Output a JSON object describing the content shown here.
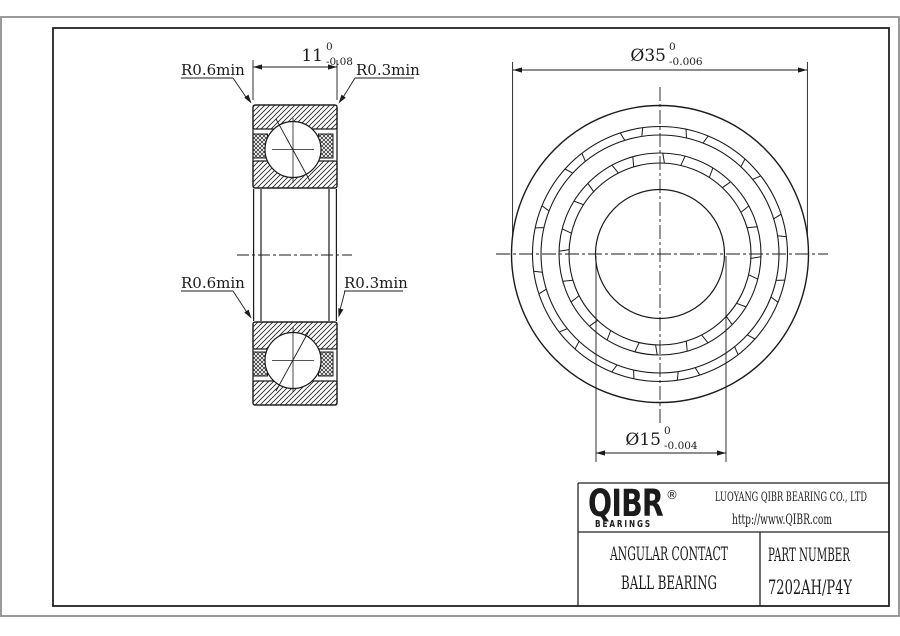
{
  "drawing": {
    "left_view": {
      "dim_width": {
        "value": "11",
        "upper": "0",
        "lower": "-0.08"
      },
      "label_r06_top": "R0.6min",
      "label_r03_top": "R0.3min",
      "label_r06_bottom": "R0.6min",
      "label_r03_bottom": "R0.3min"
    },
    "right_view": {
      "dim_od": {
        "value": "Ø35",
        "upper": "0",
        "lower": "-0.006"
      },
      "dim_bore": {
        "value": "Ø15",
        "upper": "0",
        "lower": "-0.004"
      }
    }
  },
  "title_block": {
    "brand": {
      "name": "QIBR",
      "registered": "®",
      "tagline": "BEARINGS"
    },
    "company": "LUOYANG QIBR BEARING CO., LTD",
    "website": "http://www.QIBR.com",
    "product": {
      "line1": "ANGULAR CONTACT",
      "line2": "BALL BEARING"
    },
    "part": {
      "label": "PART NUMBER",
      "number": "7202AH/P4Y"
    }
  },
  "colors": {
    "line": "#1b1b1b",
    "frame_gray": "#8f8f8f",
    "background": "#ffffff"
  }
}
